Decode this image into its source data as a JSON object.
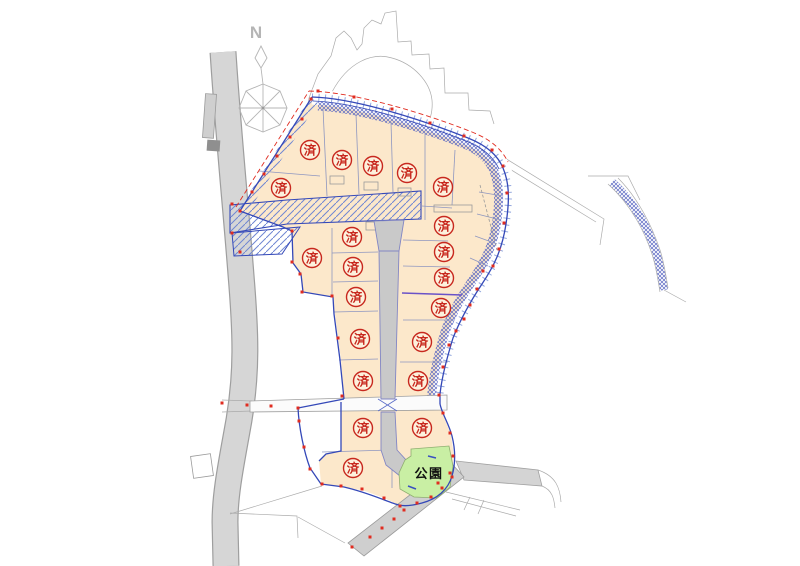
{
  "map": {
    "type": "land-lot-site-plan",
    "labels": {
      "sold": "済",
      "park": "公園",
      "north": "N"
    },
    "counts": {
      "sold_lots": 21
    },
    "colors": {
      "lot_fill": "#fce8cb",
      "road_fill": "#c9c9c9",
      "road_outer": "#d6d6d6",
      "park_fill": "#c9efa4",
      "sold_red": "#c8281e",
      "boundary_blue": "#3448b8",
      "hatch_blue": "#6f86d2",
      "survey_red": "#e02c20",
      "outline_gray": "#9a9a9a",
      "lot_line": "#8e96c0",
      "compass_gray": "#b5b5b5",
      "text_black": "#111111"
    },
    "sold_marks": [
      {
        "x": 281,
        "y": 188
      },
      {
        "x": 310,
        "y": 150
      },
      {
        "x": 342,
        "y": 160
      },
      {
        "x": 373,
        "y": 166
      },
      {
        "x": 407,
        "y": 173
      },
      {
        "x": 443,
        "y": 187
      },
      {
        "x": 352,
        "y": 237
      },
      {
        "x": 312,
        "y": 258
      },
      {
        "x": 353,
        "y": 267
      },
      {
        "x": 356,
        "y": 297
      },
      {
        "x": 444,
        "y": 226
      },
      {
        "x": 444,
        "y": 252
      },
      {
        "x": 444,
        "y": 278
      },
      {
        "x": 441,
        "y": 308
      },
      {
        "x": 360,
        "y": 339
      },
      {
        "x": 422,
        "y": 342
      },
      {
        "x": 363,
        "y": 381
      },
      {
        "x": 418,
        "y": 381
      },
      {
        "x": 363,
        "y": 428
      },
      {
        "x": 422,
        "y": 428
      },
      {
        "x": 353,
        "y": 468
      }
    ],
    "survey_points": [
      [
        240,
        211
      ],
      [
        252,
        192
      ],
      [
        264,
        174
      ],
      [
        277,
        156
      ],
      [
        290,
        137
      ],
      [
        302,
        119
      ],
      [
        311,
        99
      ],
      [
        318,
        91
      ],
      [
        354,
        97
      ],
      [
        392,
        109
      ],
      [
        430,
        123
      ],
      [
        464,
        136
      ],
      [
        492,
        150
      ],
      [
        503,
        166
      ],
      [
        507,
        193
      ],
      [
        504,
        223
      ],
      [
        499,
        249
      ],
      [
        493,
        266
      ],
      [
        483,
        271
      ],
      [
        477,
        289
      ],
      [
        470,
        305
      ],
      [
        464,
        319
      ],
      [
        456,
        331
      ],
      [
        449,
        345
      ],
      [
        443,
        367
      ],
      [
        439,
        395
      ],
      [
        443,
        413
      ],
      [
        450,
        433
      ],
      [
        453,
        456
      ],
      [
        450,
        473
      ],
      [
        442,
        488
      ],
      [
        431,
        497
      ],
      [
        417,
        503
      ],
      [
        400,
        506
      ],
      [
        384,
        498
      ],
      [
        362,
        489
      ],
      [
        341,
        486
      ],
      [
        322,
        484
      ],
      [
        310,
        469
      ],
      [
        304,
        447
      ],
      [
        299,
        421
      ],
      [
        298,
        408
      ],
      [
        292,
        231
      ],
      [
        292,
        262
      ],
      [
        300,
        274
      ],
      [
        302,
        292
      ],
      [
        332,
        296
      ],
      [
        338,
        338
      ],
      [
        342,
        396
      ],
      [
        222,
        403
      ],
      [
        247,
        405
      ],
      [
        271,
        406
      ],
      [
        232,
        204
      ],
      [
        232,
        233
      ],
      [
        240,
        252
      ],
      [
        404,
        510
      ],
      [
        394,
        519
      ],
      [
        382,
        528
      ],
      [
        370,
        537
      ],
      [
        352,
        547
      ],
      [
        438,
        483
      ],
      [
        452,
        477
      ]
    ]
  }
}
